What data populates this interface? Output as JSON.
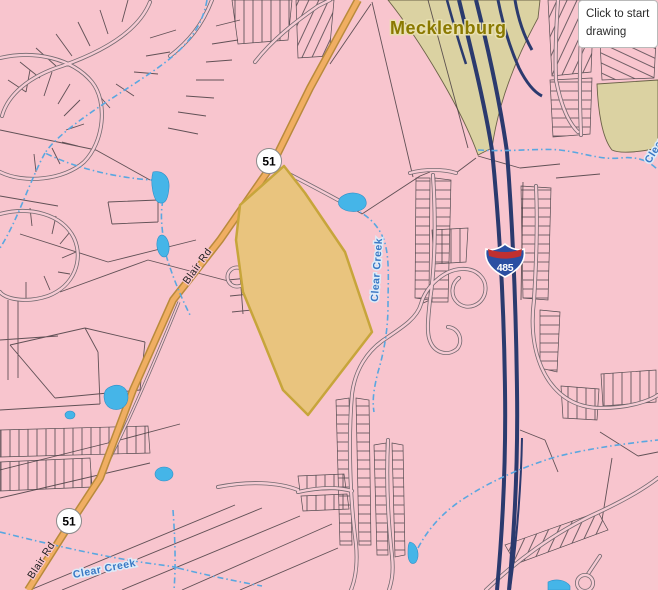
{
  "window": {
    "tooltip_text": "Click to start drawing"
  },
  "map": {
    "county_label": "Mecklenburg",
    "road_label": "Blair Rd",
    "creek_label": "Clear Creek",
    "route_51": "51",
    "interstate_485": "485",
    "highlight": {
      "feature": "selected-parcel",
      "fill": "#E9C47E",
      "border": "#C7A53B"
    },
    "colors": {
      "background": "#F8C5CE",
      "parcel_line": "#463C41",
      "khaki_area": "#DBD2A2",
      "interstate_line": "#2B3A6E",
      "route51_fill": "#F0AE62",
      "route51_casing": "#B98A3C",
      "water": "#45B5E8",
      "creek_label_color": "#3A78C4",
      "county_label_color": "#8A7900"
    }
  }
}
